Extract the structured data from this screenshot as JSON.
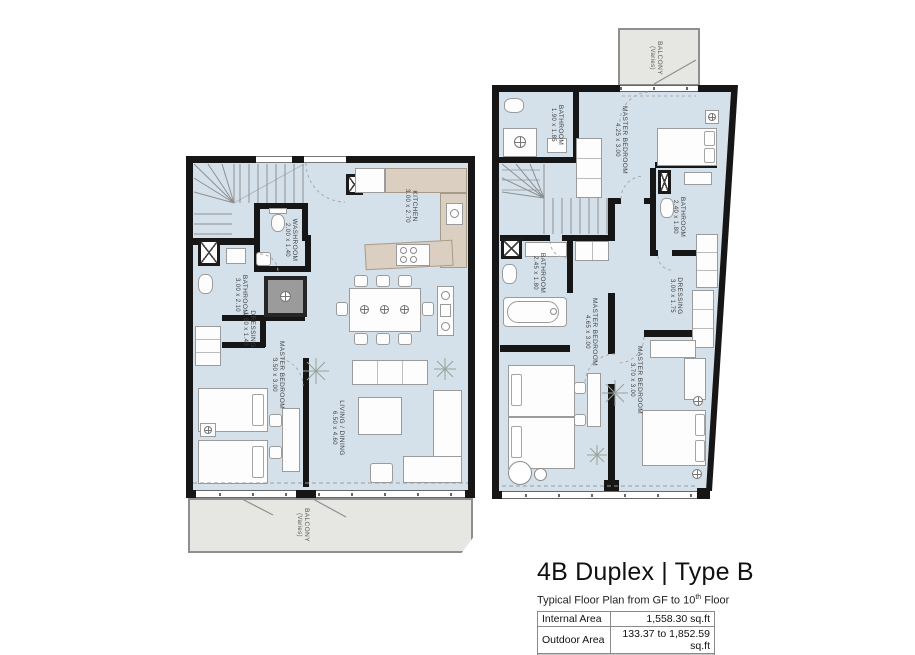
{
  "title_block": {
    "title": "4B Duplex | Type B",
    "subtitle_prefix": "Typical Floor Plan from GF to 10",
    "subtitle_sup": "th",
    "subtitle_suffix": " Floor",
    "table": {
      "rows": [
        {
          "label": "Internal Area",
          "value": "1,558.30 sq.ft"
        },
        {
          "label": "Outdoor Area",
          "value": "133.37 to 1,852.59 sq.ft"
        }
      ],
      "total": "1,691.67 to 3,411.97 sq.ft"
    }
  },
  "plans": {
    "lower": {
      "rooms": [
        {
          "name": "KITCHEN",
          "dims": "3.00 x 2.70"
        },
        {
          "name": "WASHROOM",
          "dims": "2.00 x 1.40"
        },
        {
          "name": "BATHROOM",
          "dims": "3.00 x 2.10"
        },
        {
          "name": "DRESSING",
          "dims": "1.80 x 1.40"
        },
        {
          "name": "MASTER BEDROOM",
          "dims": "3.50 x 3.00"
        },
        {
          "name": "LIVING / DINING",
          "dims": "6.50 x 4.60"
        },
        {
          "name": "BALCONY",
          "dims": "(Varies)"
        }
      ]
    },
    "upper": {
      "rooms": [
        {
          "name": "BALCONY",
          "dims": "(Varies)"
        },
        {
          "name": "BATHROOM",
          "dims": "1.90 x 1.85"
        },
        {
          "name": "MASTER BEDROOM",
          "dims": "4.25 x 3.00"
        },
        {
          "name": "BATHROOM",
          "dims": "2.40 x 1.80"
        },
        {
          "name": "BATHROOM",
          "dims": "2.45 x 1.80"
        },
        {
          "name": "DRESSING",
          "dims": "3.00 x 1.75"
        },
        {
          "name": "MASTER BEDROOM",
          "dims": "4.65 x 3.00"
        },
        {
          "name": "MASTER BEDROOM",
          "dims": "3.70 x 3.00"
        }
      ]
    }
  },
  "colors": {
    "floor": "#d5e1ea",
    "wall": "#161616",
    "balcony": "#e6e6e3",
    "kitchen_counter": "#dbcfc1",
    "table_total_bg": "#c9c9c9"
  }
}
